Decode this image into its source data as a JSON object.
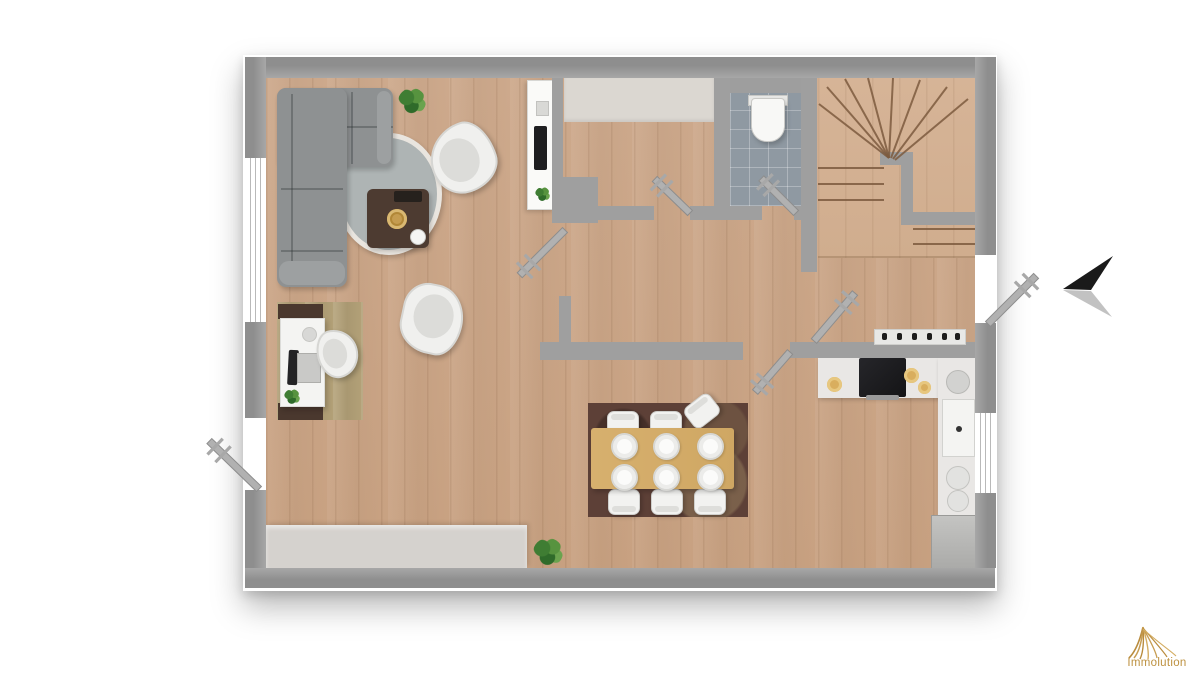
{
  "logo": {
    "text": "Immolution",
    "color": "#bd9140",
    "icon": "gold-swoosh-icon"
  },
  "compass": {
    "type": "north-arrow",
    "points": "left",
    "primary_color": "#1a1a1a",
    "shadow_color": "#c2c2c2"
  },
  "palette": {
    "wall": "#9e9e9e",
    "floor_wood": "#cba68a",
    "stairs_wood": "#d3b194",
    "wc_tile": "#8f99a2",
    "entry_mat": "#dbd7d1",
    "counter": "#e9e7e5",
    "sofa_gray": "#8e9192",
    "dining_rug": "#5d4037",
    "dining_table": "#d5ae6c",
    "desk_rug": "#b2a077",
    "accent_gold": "#c49c55"
  },
  "inventory": {
    "rooms": [
      "living-area",
      "dining-area",
      "home-office-corner",
      "entry-hall",
      "wc",
      "staircase",
      "corridor",
      "kitchen"
    ],
    "furniture": [
      "corner-sofa",
      "round-rug",
      "coffee-table",
      "armchair",
      "armchair",
      "tv-cabinet",
      "desk",
      "desk-chair",
      "dining-table",
      "dining-chairs-6",
      "sideboard",
      "kitchen-counter",
      "cooktop",
      "oven",
      "sink",
      "fridge",
      "toilet",
      "plants"
    ],
    "door_count": 7,
    "window_count": 2
  }
}
